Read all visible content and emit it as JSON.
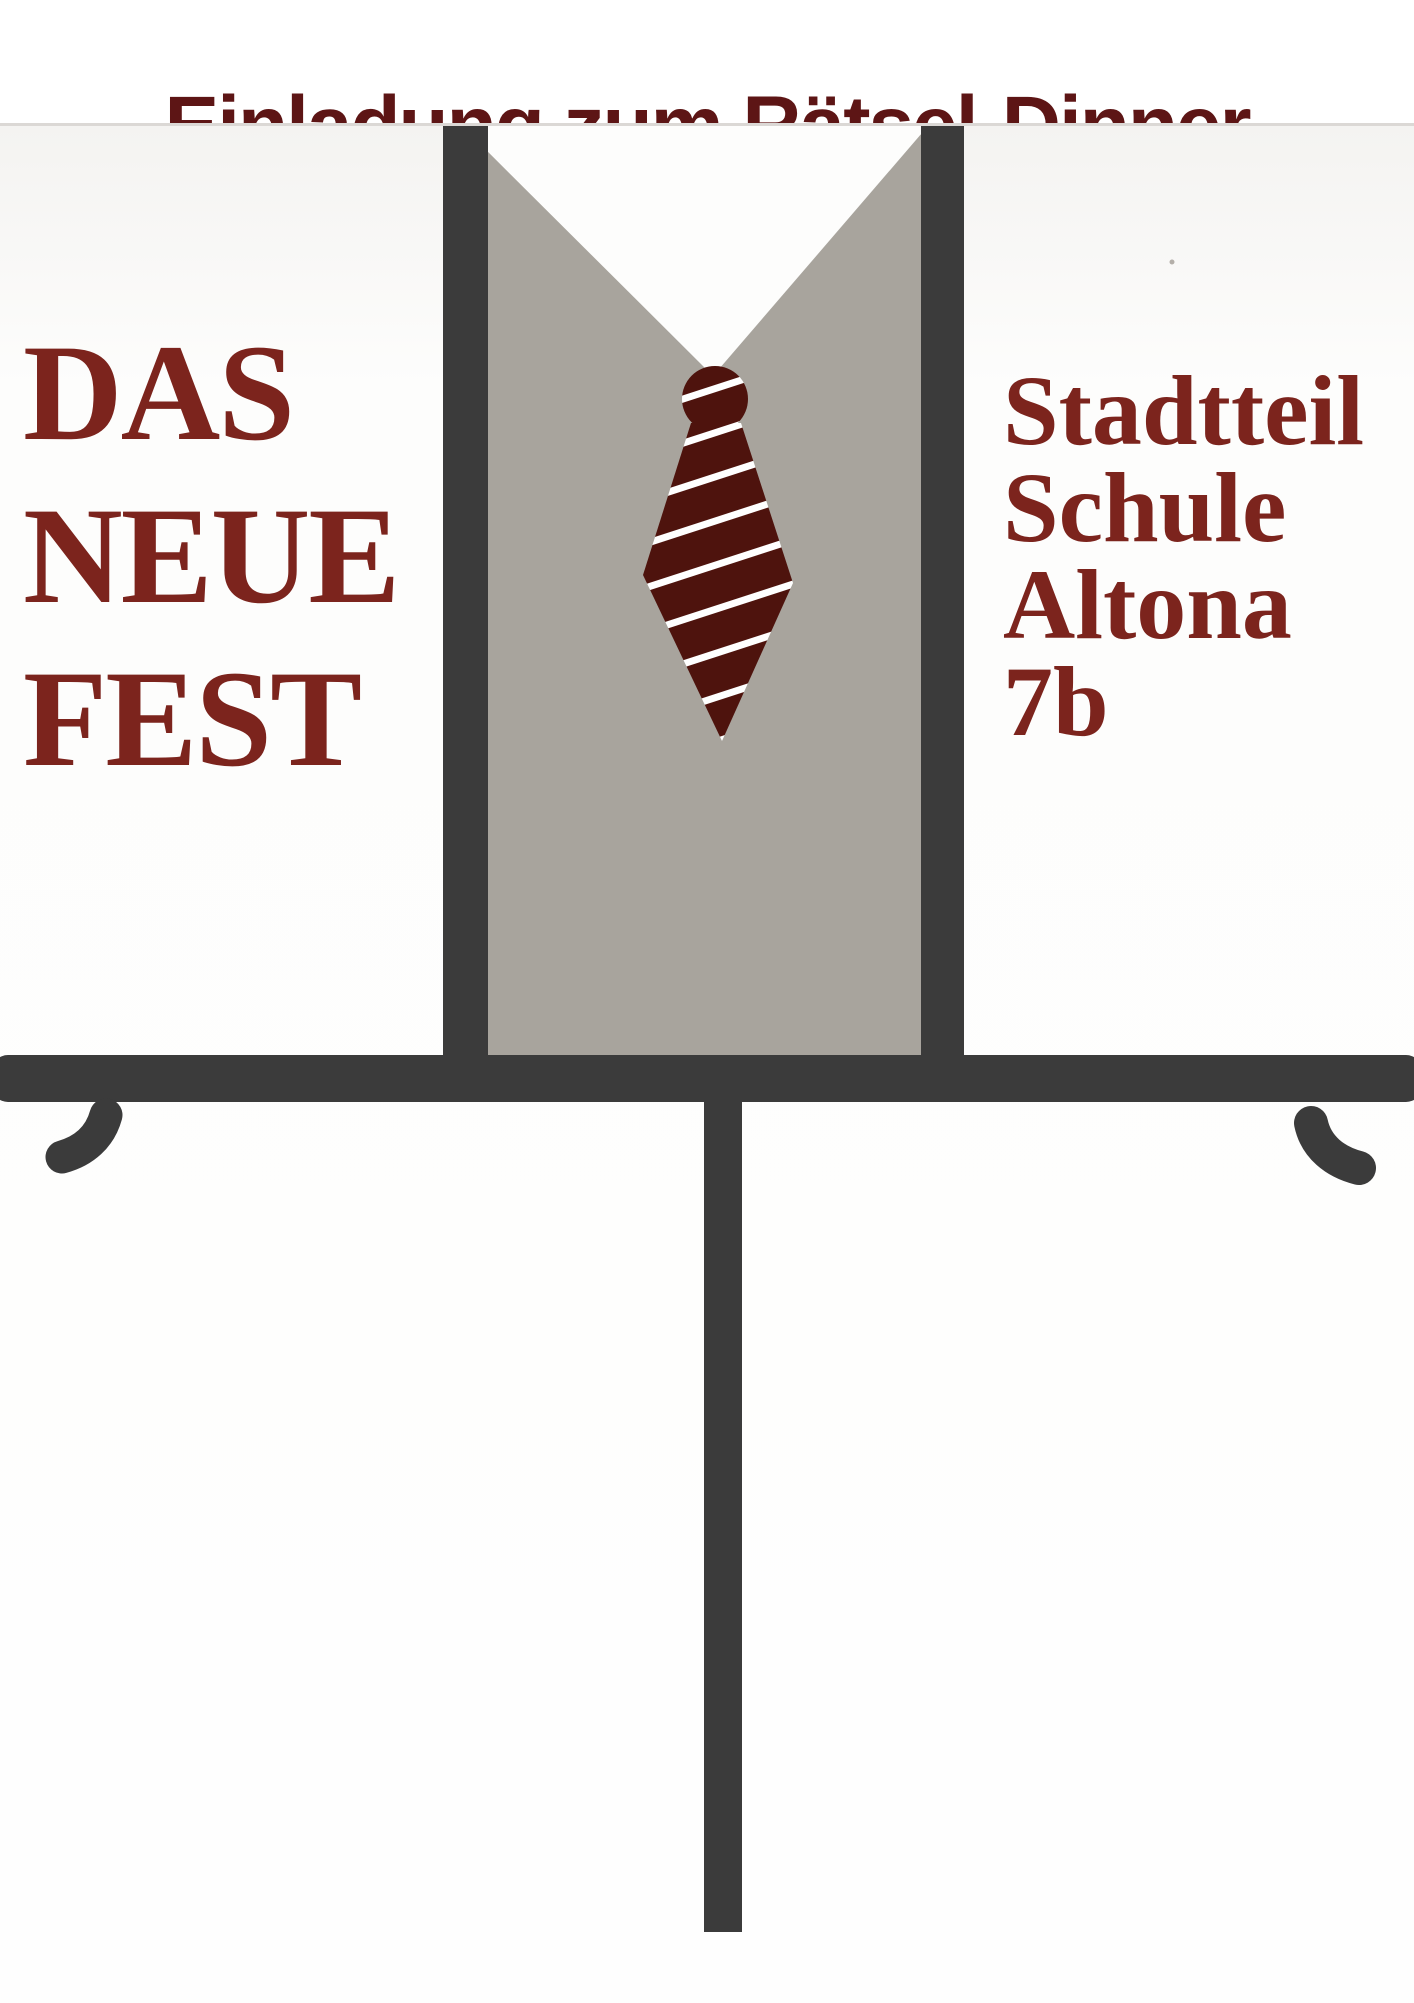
{
  "header": {
    "title": "Einladung zum Rätsel-Dinner",
    "title_color": "#5d1515"
  },
  "left_title": {
    "line1": "DAS",
    "line2": "NEUE",
    "line3": "FEST",
    "color": "#7c241d"
  },
  "right_caption": {
    "line1": "Stadtteil",
    "line2": "Schule",
    "line3": "Altona",
    "line4": "7b",
    "color": "#7c241d"
  },
  "illustration": {
    "description": "hand-drawn suit jacket with striped necktie standing behind a table",
    "colors": {
      "frame_dark": "#3b3b3b",
      "lapel_gray": "#a8a49d",
      "shirt_white": "#ffffff",
      "tie_maroon": "#4e130d",
      "tie_stripe": "#ffffff"
    }
  }
}
